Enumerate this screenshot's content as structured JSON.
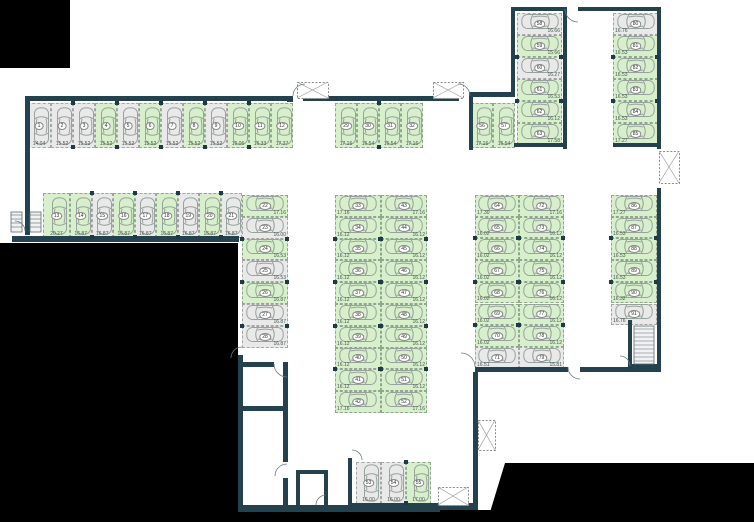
{
  "plan": {
    "type": "parking-garage-floor-plan",
    "palette": {
      "wall": "#24414e",
      "available_fill": "#d7f0cb",
      "occupied_fill": "#e9e9e9",
      "void_fill": "#000000",
      "stall_border": "#99a399",
      "car_outline": "#97a29c",
      "text": "#46564c"
    },
    "icons": [
      "car-icon",
      "elevator-shaft-icon",
      "stairs-icon",
      "door-arc-icon"
    ],
    "groups": [
      {
        "name": "top-row",
        "x": 27,
        "y": 103,
        "dir": "x",
        "o": "v",
        "sw": 22,
        "sh": 45,
        "m": "b",
        "stalls": [
          {
            "n": "1",
            "a": "14.04",
            "hl": 0,
            "w": 24
          },
          {
            "n": "2",
            "a": "15.52",
            "hl": 0
          },
          {
            "n": "3",
            "a": "15.52",
            "hl": 0
          },
          {
            "n": "4",
            "a": "15.52",
            "hl": 1
          },
          {
            "n": "5",
            "a": "15.52",
            "hl": 0
          },
          {
            "n": "6",
            "a": "15.52",
            "hl": 1
          },
          {
            "n": "7",
            "a": "15.52",
            "hl": 0
          },
          {
            "n": "8",
            "a": "15.52",
            "hl": 1
          },
          {
            "n": "9",
            "a": "15.52",
            "hl": 0
          },
          {
            "n": "10",
            "a": "16.06",
            "hl": 1
          },
          {
            "n": "11",
            "a": "16.33",
            "hl": 1
          },
          {
            "n": "12",
            "a": "17.37",
            "hl": 1
          }
        ]
      },
      {
        "name": "mid-top-row",
        "x": 335,
        "y": 103,
        "dir": "x",
        "o": "v",
        "sw": 22,
        "sh": 45,
        "m": "b",
        "stalls": [
          {
            "n": "29",
            "a": "17.16",
            "hl": 1
          },
          {
            "n": "30",
            "a": "16.54",
            "hl": 1
          },
          {
            "n": "31",
            "a": "16.54",
            "hl": 1
          },
          {
            "n": "32",
            "a": "17.16",
            "hl": 1
          }
        ]
      },
      {
        "name": "stalls-56-57",
        "x": 471,
        "y": 103,
        "dir": "x",
        "o": "v",
        "sw": 22,
        "sh": 45,
        "m": "b",
        "stalls": [
          {
            "n": "56",
            "a": "17.16",
            "hl": 1
          },
          {
            "n": "57",
            "a": "16.54",
            "hl": 1
          }
        ]
      },
      {
        "name": "second-row",
        "x": 43,
        "y": 193,
        "dir": "x",
        "o": "v",
        "sw": 21.5,
        "sh": 45,
        "m": "b",
        "stalls": [
          {
            "n": "13",
            "a": "20.27",
            "hl": 1,
            "w": 27
          },
          {
            "n": "14",
            "a": "16.87",
            "hl": 1
          },
          {
            "n": "15",
            "a": "16.87",
            "hl": 0
          },
          {
            "n": "16",
            "a": "16.87",
            "hl": 1
          },
          {
            "n": "17",
            "a": "16.87",
            "hl": 0
          },
          {
            "n": "18",
            "a": "16.87",
            "hl": 1
          },
          {
            "n": "19",
            "a": "16.87",
            "hl": 0
          },
          {
            "n": "20",
            "a": "16.87",
            "hl": 1
          },
          {
            "n": "21",
            "a": "16.87",
            "hl": 0
          }
        ]
      },
      {
        "name": "col-22-28",
        "x": 242,
        "y": 195,
        "dir": "y",
        "o": "h",
        "sw": 46,
        "sh": 21.8,
        "m": "br",
        "stalls": [
          {
            "n": "22",
            "a": "17.16",
            "hl": 1
          },
          {
            "n": "23",
            "a": "16.00",
            "hl": 0
          },
          {
            "n": "24",
            "a": "16.53",
            "hl": 1
          },
          {
            "n": "25",
            "a": "16.53",
            "hl": 0
          },
          {
            "n": "26",
            "a": "16.87",
            "hl": 1
          },
          {
            "n": "27",
            "a": "16.87",
            "hl": 0
          },
          {
            "n": "28",
            "a": "16.87",
            "hl": 0
          }
        ]
      },
      {
        "name": "mid-col-left",
        "x": 335,
        "y": 195,
        "dir": "y",
        "o": "h",
        "sw": 46,
        "sh": 21.8,
        "m": "bl",
        "stalls": [
          {
            "n": "33",
            "a": "17.16",
            "hl": 1
          },
          {
            "n": "34",
            "a": "16.12",
            "hl": 1
          },
          {
            "n": "35",
            "a": "16.12",
            "hl": 1
          },
          {
            "n": "36",
            "a": "16.12",
            "hl": 1
          },
          {
            "n": "37",
            "a": "16.12",
            "hl": 1
          },
          {
            "n": "38",
            "a": "16.12",
            "hl": 1
          },
          {
            "n": "39",
            "a": "16.12",
            "hl": 1
          },
          {
            "n": "40",
            "a": "16.12",
            "hl": 1
          },
          {
            "n": "41",
            "a": "16.12",
            "hl": 1
          },
          {
            "n": "42",
            "a": "17.16",
            "hl": 1
          }
        ]
      },
      {
        "name": "mid-col-right",
        "x": 381,
        "y": 195,
        "dir": "y",
        "o": "h",
        "sw": 46,
        "sh": 21.8,
        "m": "br",
        "stalls": [
          {
            "n": "43",
            "a": "17.16",
            "hl": 1
          },
          {
            "n": "44",
            "a": "16.12",
            "hl": 1
          },
          {
            "n": "45",
            "a": "16.12",
            "hl": 1
          },
          {
            "n": "46",
            "a": "16.12",
            "hl": 1
          },
          {
            "n": "47",
            "a": "16.12",
            "hl": 1
          },
          {
            "n": "48",
            "a": "16.12",
            "hl": 1
          },
          {
            "n": "49",
            "a": "16.12",
            "hl": 1
          },
          {
            "n": "50",
            "a": "16.12",
            "hl": 1
          },
          {
            "n": "51",
            "a": "16.12",
            "hl": 1
          },
          {
            "n": "52",
            "a": "17.16",
            "hl": 1
          }
        ]
      },
      {
        "name": "right-col-64-71",
        "x": 475,
        "y": 195,
        "dir": "y",
        "o": "h",
        "sw": 44,
        "sh": 21.7,
        "m": "bl",
        "stalls": [
          {
            "n": "64",
            "a": "17.30",
            "hl": 1
          },
          {
            "n": "65",
            "a": "16.02",
            "hl": 1
          },
          {
            "n": "66",
            "a": "16.02",
            "hl": 1
          },
          {
            "n": "67",
            "a": "16.02",
            "hl": 1
          },
          {
            "n": "68",
            "a": "16.02",
            "hl": 1
          },
          {
            "n": "69",
            "a": "16.02",
            "hl": 1
          },
          {
            "n": "70",
            "a": "16.02",
            "hl": 1
          },
          {
            "n": "71",
            "a": "16.51",
            "hl": 0
          }
        ]
      },
      {
        "name": "right-col-72-79",
        "x": 519,
        "y": 195,
        "dir": "y",
        "o": "h",
        "sw": 45,
        "sh": 21.7,
        "m": "br",
        "stalls": [
          {
            "n": "72",
            "a": "17.16",
            "hl": 1
          },
          {
            "n": "73",
            "a": "16.12",
            "hl": 1
          },
          {
            "n": "74",
            "a": "16.12",
            "hl": 1
          },
          {
            "n": "75",
            "a": "16.12",
            "hl": 1
          },
          {
            "n": "76",
            "a": "16.12",
            "hl": 1
          },
          {
            "n": "77",
            "a": "16.12",
            "hl": 1
          },
          {
            "n": "78",
            "a": "16.12",
            "hl": 1
          },
          {
            "n": "79",
            "a": "15.81",
            "hl": 0
          }
        ]
      },
      {
        "name": "tr-col-58-63",
        "x": 517,
        "y": 13,
        "dir": "y",
        "o": "h",
        "sw": 45,
        "sh": 22,
        "m": "br",
        "stalls": [
          {
            "n": "58",
            "a": "16.66",
            "hl": 0
          },
          {
            "n": "59",
            "a": "15.66",
            "hl": 1
          },
          {
            "n": "60",
            "a": "16.27",
            "hl": 0
          },
          {
            "n": "61",
            "a": "16.53",
            "hl": 1
          },
          {
            "n": "62",
            "a": "16.12",
            "hl": 1
          },
          {
            "n": "63",
            "a": "17.58",
            "hl": 1
          }
        ]
      },
      {
        "name": "tr-col-80-85",
        "x": 613,
        "y": 13,
        "dir": "y",
        "o": "h",
        "sw": 45,
        "sh": 22,
        "m": "bl",
        "stalls": [
          {
            "n": "80",
            "a": "16.76",
            "hl": 0
          },
          {
            "n": "81",
            "a": "16.53",
            "hl": 1
          },
          {
            "n": "82",
            "a": "16.53",
            "hl": 1
          },
          {
            "n": "83",
            "a": "16.53",
            "hl": 1
          },
          {
            "n": "84",
            "a": "16.53",
            "hl": 1
          },
          {
            "n": "85",
            "a": "17.27",
            "hl": 1
          }
        ]
      },
      {
        "name": "fr-col-86-91",
        "x": 611,
        "y": 195,
        "dir": "y",
        "o": "h",
        "sw": 46,
        "sh": 21.7,
        "m": "bl",
        "stalls": [
          {
            "n": "86",
            "a": "17.27",
            "hl": 1
          },
          {
            "n": "87",
            "a": "16.53",
            "hl": 1
          },
          {
            "n": "88",
            "a": "16.53",
            "hl": 1
          },
          {
            "n": "89",
            "a": "16.53",
            "hl": 1
          },
          {
            "n": "90",
            "a": "16.32",
            "hl": 1
          },
          {
            "n": "91",
            "a": "16.76",
            "hl": 0
          }
        ]
      },
      {
        "name": "bottom-53-55",
        "x": 356,
        "y": 462,
        "dir": "x",
        "o": "v",
        "sw": 25,
        "sh": 42,
        "m": "b",
        "stalls": [
          {
            "n": "53",
            "a": "16.00",
            "hl": 0
          },
          {
            "n": "54",
            "a": "16.00",
            "hl": 0
          },
          {
            "n": "55",
            "a": "17.00",
            "hl": 1
          }
        ]
      }
    ]
  }
}
